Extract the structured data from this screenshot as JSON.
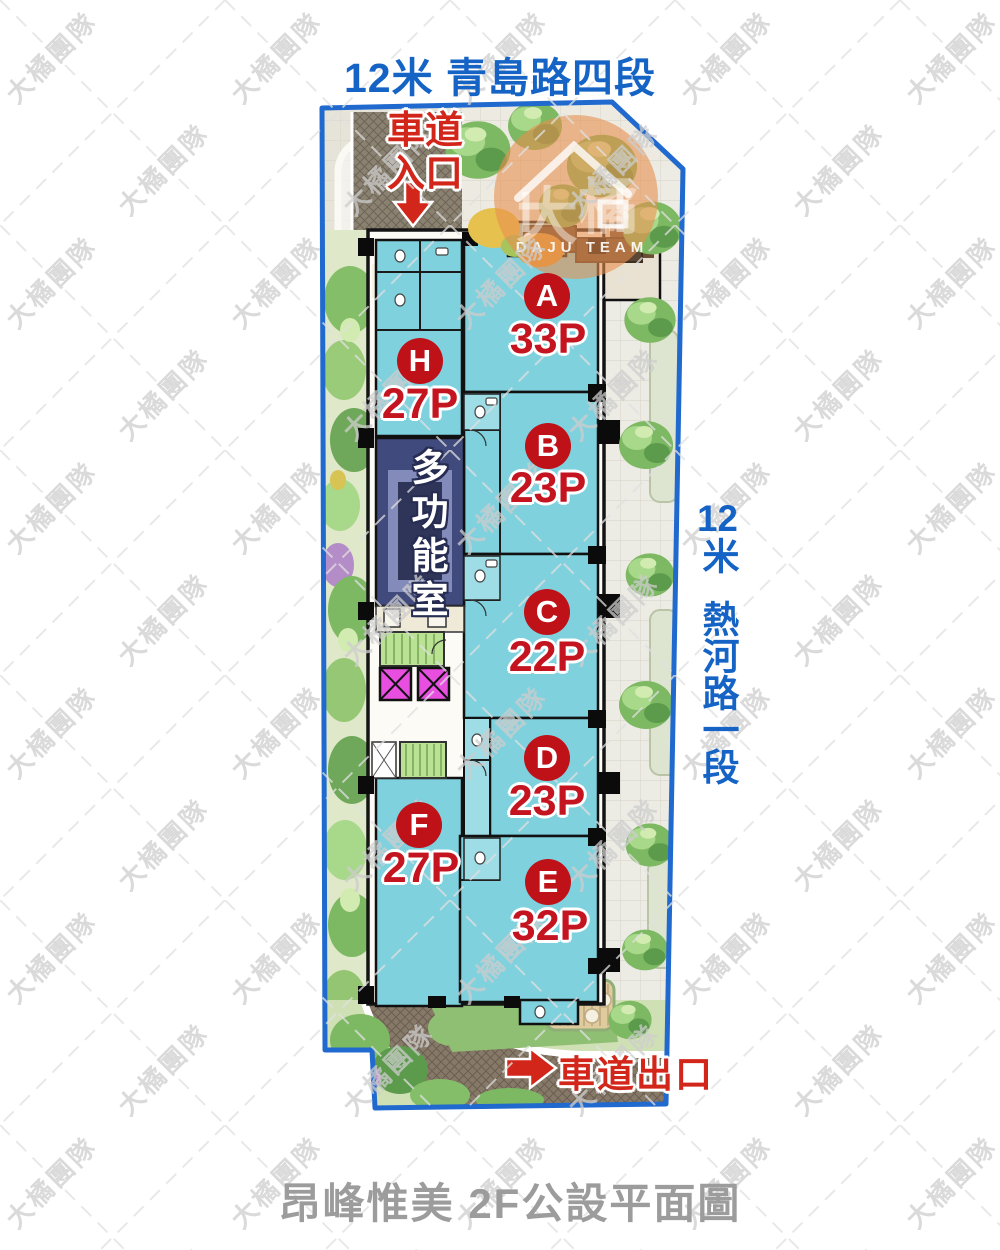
{
  "streets": {
    "top": "12米 青島路四段",
    "right_num": "12",
    "right_unit": "米",
    "right_name": "熱河路一段"
  },
  "driveway": {
    "entrance": "車道入口",
    "exit": "車道出口"
  },
  "units": [
    {
      "letter": "A",
      "size": "33P"
    },
    {
      "letter": "B",
      "size": "23P"
    },
    {
      "letter": "C",
      "size": "22P"
    },
    {
      "letter": "D",
      "size": "23P"
    },
    {
      "letter": "E",
      "size": "32P"
    },
    {
      "letter": "F",
      "size": "27P"
    },
    {
      "letter": "H",
      "size": "27P"
    }
  ],
  "plan": {
    "multi_room": "多功能室"
  },
  "watermark": {
    "text": "大橘團隊"
  },
  "logo": {
    "team": "DAJU TEAM"
  },
  "title": "昂峰惟美 2F公設平面圖",
  "colors": {
    "street_blue": "#1563C4",
    "border_blue": "#2069CE",
    "label_red": "#D3261B",
    "badge_red": "#BE1118",
    "unit_cyan": "#7FD1DE",
    "multi_room_navy": "#404A7C",
    "stair_green": "#B9E292",
    "elevator_magenta": "#E84FE0",
    "title_gray": "#9C9C9C",
    "logo_orange": "#E8904F"
  }
}
